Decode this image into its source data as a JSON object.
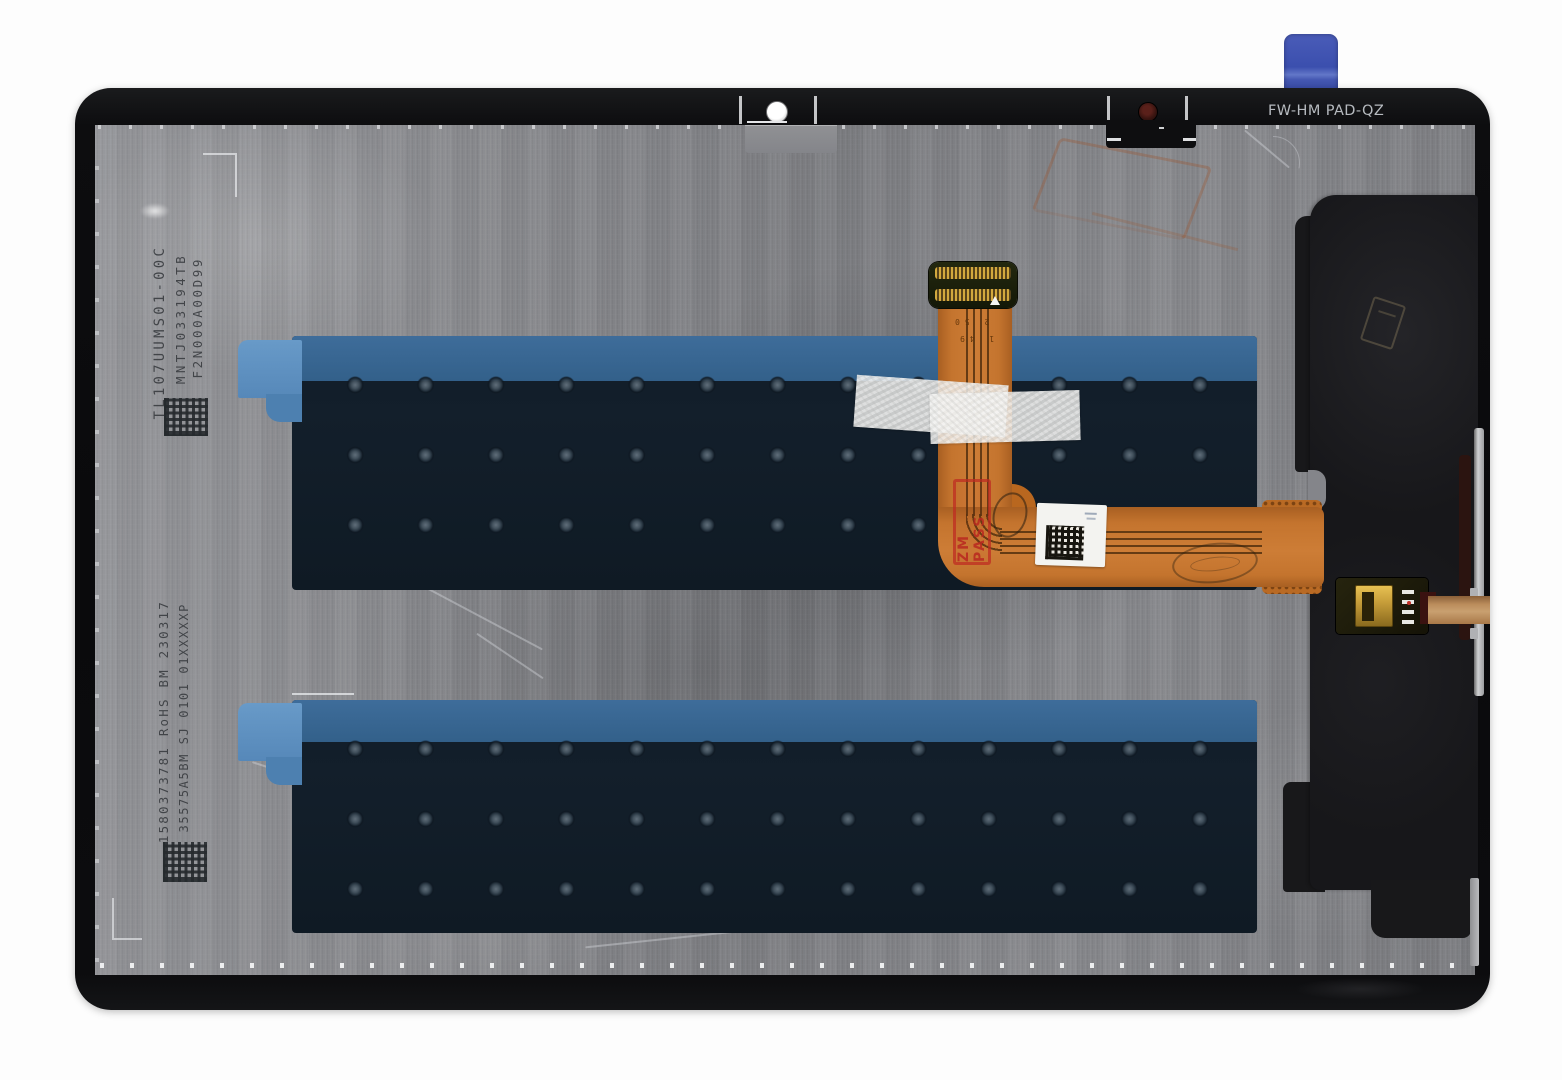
{
  "photo": {
    "bezel": {
      "model_text": "FW-HM PAD-QZ"
    },
    "markings": {
      "top_left_vertical": [
        "TL107UUMS01-00C",
        "MNTJ033194TB",
        "F2N000A00D99"
      ],
      "bottom_left_vertical": [
        "1580373781 RoHS BM 230317",
        "35575A5BM SJ 0101 01XXXXXP"
      ],
      "flex_stamp": "ZM PASS",
      "flex_pin_row_top": "2    50",
      "flex_pin_row_bottom": "1    49"
    },
    "colors": {
      "background": "#ffffff",
      "bezel_black": "#0d0d0f",
      "metal_gray": "#85868a",
      "adhesive_pad_navy": "#121e2a",
      "tape_blue": "#3a6b99",
      "pull_tab_blue": "#3c52b0",
      "flex_orange": "#c4742e",
      "stamp_red": "#c0392b",
      "connector_gold": "#c79e3a"
    }
  }
}
